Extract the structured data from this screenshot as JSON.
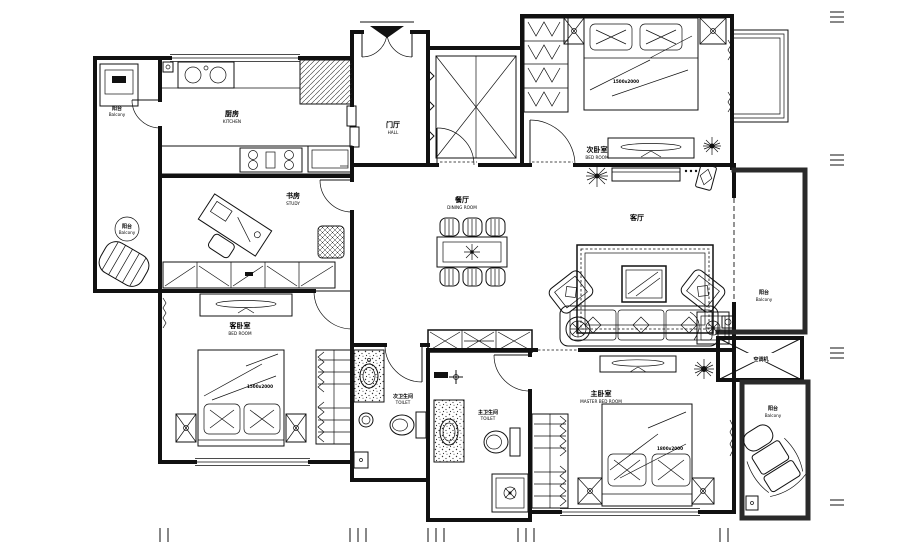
{
  "colors": {
    "line": "#111111",
    "background": "#ffffff"
  },
  "rooms": {
    "balcony_left": {
      "cn": "阳台",
      "en": "Balcony"
    },
    "kitchen": {
      "cn": "厨房",
      "en": "KITCHEN"
    },
    "study": {
      "cn": "书房",
      "en": "STUDY"
    },
    "hall": {
      "cn": "门厅",
      "en": "HALL"
    },
    "bedroom_second": {
      "cn": "次卧室",
      "en": "BED ROOM"
    },
    "dining": {
      "cn": "餐厅",
      "en": "DINING ROOM"
    },
    "living": {
      "cn": "客厅",
      "en": ""
    },
    "balcony_right": {
      "cn": "阳台",
      "en": "Balcony"
    },
    "ac_platform": {
      "cn": "空调机",
      "en": ""
    },
    "balcony_bottom_right": {
      "cn": "阳台",
      "en": "Balcony"
    },
    "bedroom_guest": {
      "cn": "客卧室",
      "en": "BED ROOM"
    },
    "toilet_second": {
      "cn": "次卫生间",
      "en": "TOILET"
    },
    "toilet_master": {
      "cn": "主卫生间",
      "en": "TOILET"
    },
    "bedroom_master": {
      "cn": "主卧室",
      "en": "MASTER BED ROOM"
    }
  },
  "furniture": {
    "bed_second_size": "1500x2000",
    "bed_guest_size": "1500x2000",
    "bed_master_size": "1800x2000"
  }
}
